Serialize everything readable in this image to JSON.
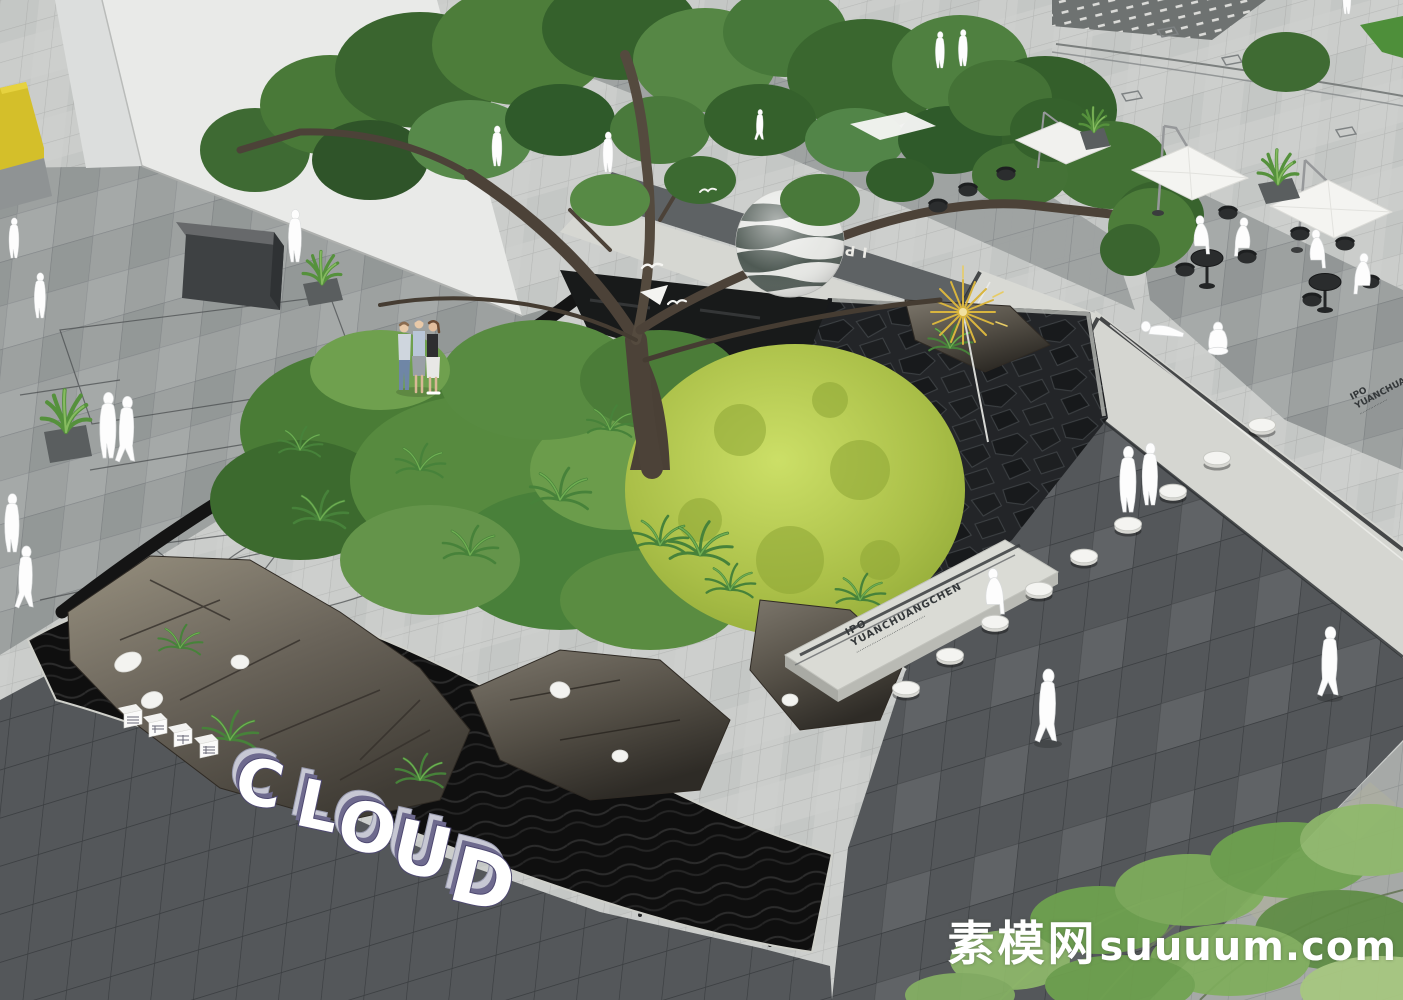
{
  "scene": {
    "description": "Aerial 3D landscape render of a plaza: rock-and-moss garden island with a large tree, striped sphere lantern, gold starburst sculpture, black water edge, stepping-stool walkway, cafe terrace and white mannequin figures",
    "watermark": {
      "cn": "素模网",
      "latin": "suuuum.com"
    },
    "signage": {
      "cloud_letters": [
        "C",
        "L",
        "O",
        "U",
        "D"
      ],
      "prefix_blocks_count": 4,
      "bench_inscription": {
        "line1": "IPO",
        "line2": "YUANCHUANGCHEN",
        "line3": "·········································"
      },
      "pavement_inlay_fragment": "IPO CH",
      "edge_inscription": {
        "line1": "IPO",
        "line2": "YUANCHUANGCHEN",
        "line3": "··················"
      }
    },
    "palette": {
      "paving_light": "#cbcdcb",
      "paving_mid": "#9da1a0",
      "paving_dark": "#54575a",
      "walkway_concrete": "#d8d9d4",
      "water_black": "#101010",
      "moss_green": "#aec24a",
      "foliage_green": "#4b7a38",
      "rock_brown": "#5c564c",
      "accent_yellow": "#d4bf2a",
      "starburst_gold": "#d9b53e",
      "figure_white": "#fdfdfd",
      "letter_stripe_navy": "#4d4870"
    },
    "counts": {
      "umbrellas": 3,
      "stepping_stools": 9,
      "white_figures": 20,
      "sketch_figures": 3,
      "cafe_tables": 2
    }
  }
}
